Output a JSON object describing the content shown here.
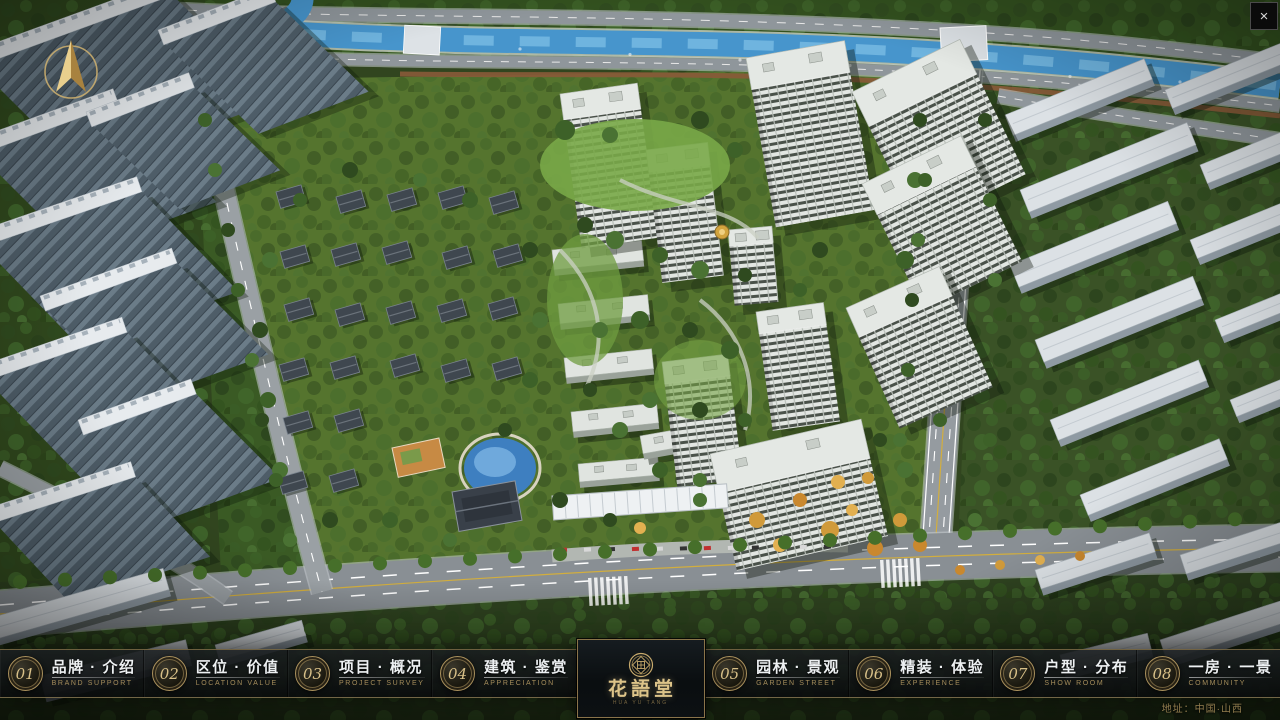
{
  "window": {
    "close_icon": "×"
  },
  "logo": {
    "title": "花語堂",
    "subtitle": "HUA YU TANG"
  },
  "footer_address": "地址：中国·山西",
  "menu": {
    "items": [
      {
        "num": "01",
        "zh": "品牌 · 介绍",
        "en": "BRAND SUPPORT"
      },
      {
        "num": "02",
        "zh": "区位 · 价值",
        "en": "LOCATION VALUE"
      },
      {
        "num": "03",
        "zh": "项目 · 概况",
        "en": "PROJECT SURVEY"
      },
      {
        "num": "04",
        "zh": "建筑 · 鉴赏",
        "en": "APPRECIATION"
      },
      {
        "num": "05",
        "zh": "园林 · 景观",
        "en": "GARDEN STREET"
      },
      {
        "num": "06",
        "zh": "精装 · 体验",
        "en": "EXPERIENCE"
      },
      {
        "num": "07",
        "zh": "户型 · 分布",
        "en": "SHOW ROOM"
      },
      {
        "num": "08",
        "zh": "一房 · 一景",
        "en": "COMMUNITY"
      }
    ]
  },
  "colors": {
    "gold": "#c9ab6d",
    "bar_bg": "#101416",
    "river": "#4795cc"
  }
}
